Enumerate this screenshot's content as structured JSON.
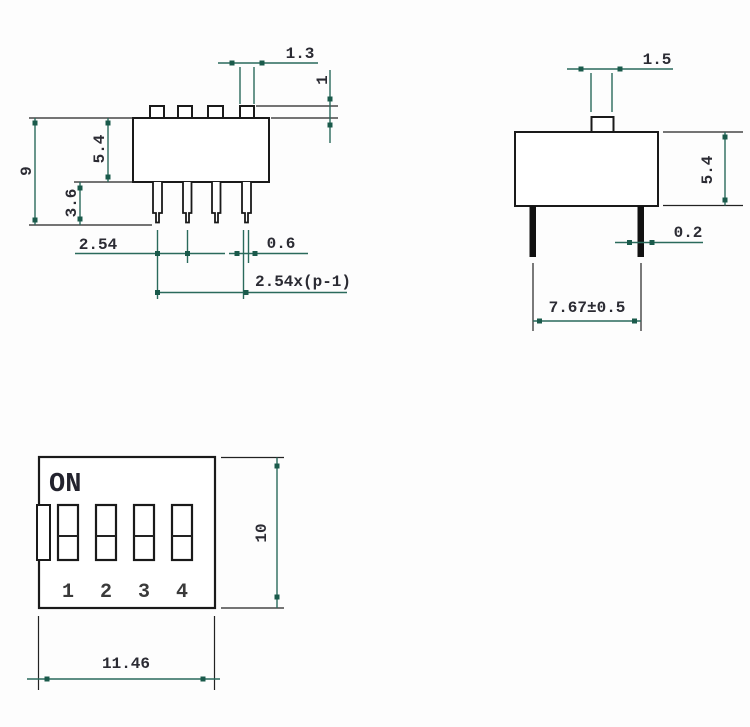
{
  "drawing_title": "DIP switch dimensional drawing (front, side and top views)",
  "colors": {
    "background": "#fdfdfd",
    "outline": "#1a1a1a",
    "dimension_line": "#2a6a5c",
    "dimension_marker": "#1a5a4b",
    "text": "#2b2b33"
  },
  "front_view": {
    "dim_tab_width": "1.3",
    "dim_tab_height": "1",
    "dim_total_height": "9",
    "dim_body_height": "5.4",
    "dim_pin_length": "3.6",
    "dim_pin_pitch": "2.54",
    "dim_pin_width": "0.6",
    "dim_pin_span": "2.54x(p-1)"
  },
  "side_view": {
    "dim_actuator_width": "1.5",
    "dim_body_height": "5.4",
    "dim_pin_thickness": "0.2",
    "dim_pin_row_span": "7.67±0.5"
  },
  "bottom_view": {
    "on_label": "ON",
    "position_labels": [
      "1",
      "2",
      "3",
      "4"
    ],
    "dim_body_height": "10",
    "dim_body_width": "11.46"
  }
}
